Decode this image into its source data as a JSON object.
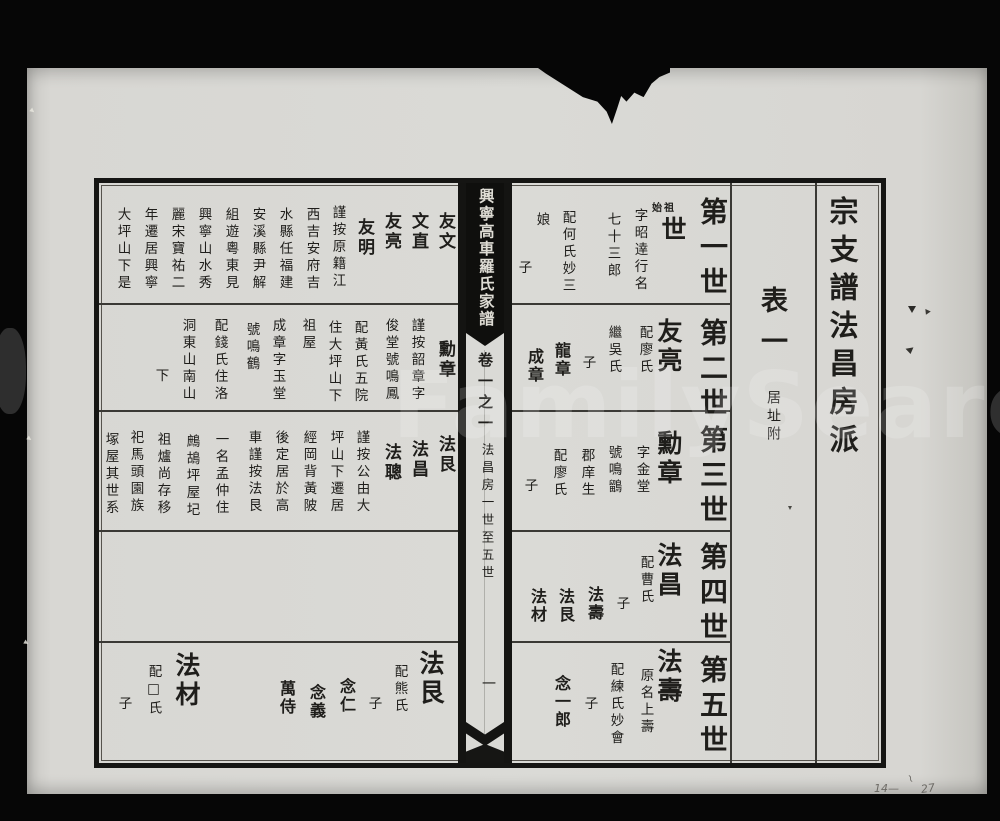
{
  "spine": {
    "book_title": "興寧高車羅氏家譜",
    "volume_label": "卷一之一",
    "section_range": "法昌房一世至五世",
    "page_number": "一"
  },
  "right_page": {
    "section_title": "宗支譜法昌房派",
    "table_label": "表一",
    "table_sublabel": "居址附",
    "generations": [
      {
        "label": "第一世",
        "ancestor_marker": "始祖",
        "name": "世",
        "notes": [
          "字昭逹行名",
          "七十三郎",
          "配何氏妙三",
          "娘"
        ],
        "son_marker": "子",
        "sons": []
      },
      {
        "label": "第二世",
        "name": "友亮",
        "notes": [
          "配廖氏",
          "繼吳氏"
        ],
        "son_marker": "子",
        "sons": [
          "龍章",
          "成章"
        ]
      },
      {
        "label": "第三世",
        "name": "勳章",
        "notes": [
          "字金堂",
          "號鳴鶹",
          "郡庠生",
          "配廖氏"
        ],
        "son_marker": "子",
        "sons": []
      },
      {
        "label": "第四世",
        "name": "法昌",
        "notes": [
          "配曹氏"
        ],
        "son_marker": "子",
        "sons": [
          "法壽",
          "法艮",
          "法材"
        ]
      },
      {
        "label": "第五世",
        "name": "法壽",
        "notes": [
          "原名上壽",
          "配練氏妙會"
        ],
        "son_marker": "子",
        "sons": [
          "念一郎"
        ]
      }
    ]
  },
  "left_page": {
    "rows": [
      {
        "names": [
          "友文",
          "文直",
          "友亮",
          "友明"
        ],
        "note_columns": [
          "謹按原籍江",
          "西吉安府吉",
          "水縣任福建",
          "安溪縣尹解",
          "組遊粵東見",
          "興寧山水秀",
          "麗宋寶祐二",
          "年遷居興寧",
          "大坪山下是"
        ]
      },
      {
        "names": [
          "勳章"
        ],
        "note_columns": [
          "謹按韶章字",
          "俊堂號鳴鳳",
          "配黃氏五院",
          "住大坪山下",
          "祖屋",
          "成章字玉堂",
          "號鳴鶴",
          "配錢氏住洛",
          "洞東山南山",
          "下"
        ]
      },
      {
        "names": [
          "法艮",
          "法昌",
          "法聰"
        ],
        "note_columns": [
          "謹按公由大",
          "坪山下遷居",
          "經岡背黃陂",
          "後定居於高",
          "車謹按法艮",
          "一名孟仲住",
          "鷓鴣坪屋圮",
          "祖爐尚存移",
          "祀馬頭園族",
          "塚屋其世系"
        ]
      },
      {
        "names": [],
        "note_columns": []
      },
      {
        "entries": [
          {
            "name": "法艮",
            "spouse": "配熊氏",
            "son_marker": "子",
            "sons": [
              "念仁",
              "念義",
              "萬侍"
            ]
          },
          {
            "name": "法材",
            "spouse": "配□氏",
            "son_marker": "子",
            "sons": []
          }
        ]
      }
    ]
  },
  "artifacts": {
    "watermark": "FamilySearch",
    "pencil_left": "14—",
    "pencil_mid": "~",
    "pencil_right": "27"
  }
}
